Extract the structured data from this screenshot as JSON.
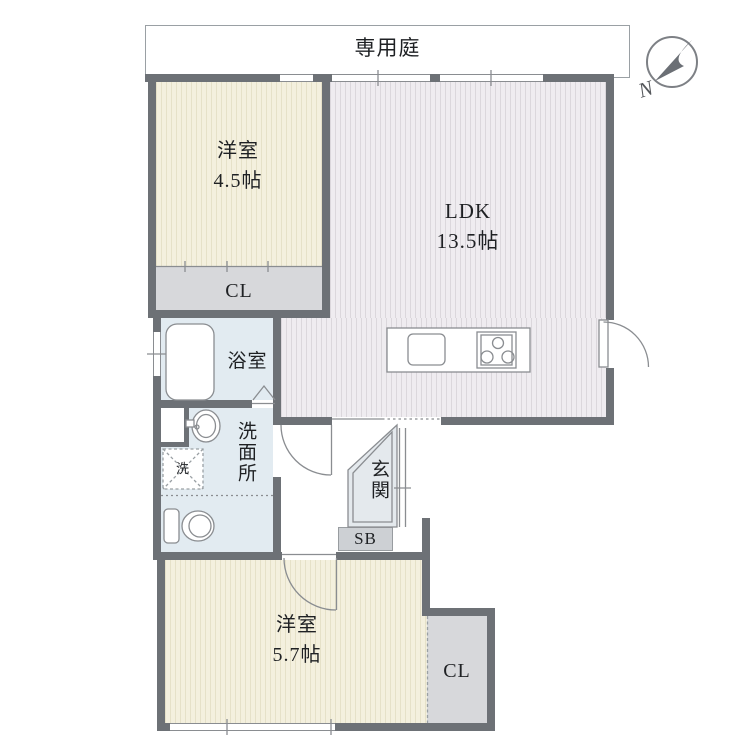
{
  "garden": {
    "label": "専用庭"
  },
  "compass": {
    "north_label": "N"
  },
  "rooms": {
    "bedroom1": {
      "name": "洋室",
      "size": "4.5帖"
    },
    "ldk": {
      "name": "LDK",
      "size": "13.5帖"
    },
    "closet1": {
      "label": "CL"
    },
    "bathroom": {
      "label": "浴室"
    },
    "washroom": {
      "label": "洗面所"
    },
    "laundry": {
      "label": "洗"
    },
    "entrance": {
      "label": "玄関"
    },
    "shoebox": {
      "label": "SB"
    },
    "bedroom2": {
      "name": "洋室",
      "size": "5.7帖"
    },
    "closet2": {
      "label": "CL"
    }
  },
  "colors": {
    "wall": "#6d7176",
    "tatami_floor": "#f4f0de",
    "ldk_floor": "#efecf0",
    "wet_area": "#e2ebf1",
    "closet": "#d7d8db",
    "entrance_floor": "#e4e9ed"
  }
}
